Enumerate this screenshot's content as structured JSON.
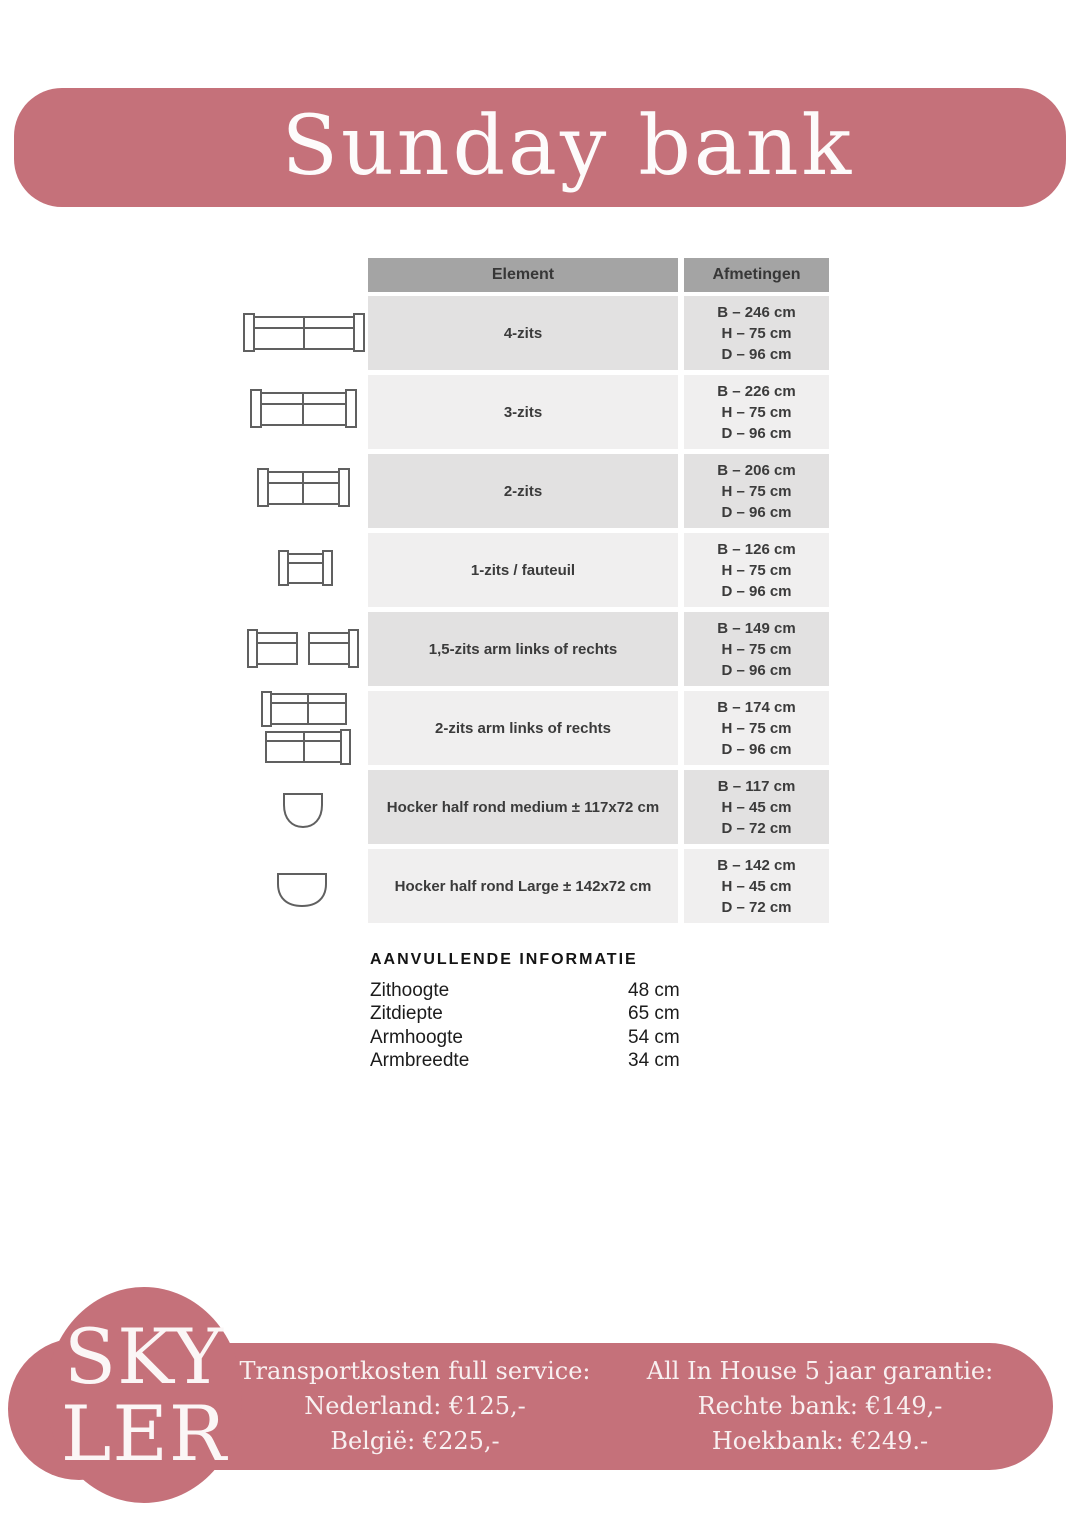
{
  "page": {
    "title": "Sunday bank"
  },
  "table": {
    "headers": {
      "element": "Element",
      "afmetingen": "Afmetingen"
    },
    "rows": [
      {
        "element": "4-zits",
        "dims": [
          "B – 246 cm",
          "H – 75 cm",
          "D – 96 cm"
        ]
      },
      {
        "element": "3-zits",
        "dims": [
          "B – 226 cm",
          "H – 75 cm",
          "D – 96 cm"
        ]
      },
      {
        "element": "2-zits",
        "dims": [
          "B – 206 cm",
          "H – 75 cm",
          "D – 96 cm"
        ]
      },
      {
        "element": "1-zits / fauteuil",
        "dims": [
          "B – 126 cm",
          "H – 75 cm",
          "D – 96 cm"
        ]
      },
      {
        "element": "1,5-zits arm links of rechts",
        "dims": [
          "B – 149 cm",
          "H – 75 cm",
          "D – 96 cm"
        ]
      },
      {
        "element": "2-zits arm links of rechts",
        "dims": [
          "B – 174 cm",
          "H – 75 cm",
          "D – 96 cm"
        ]
      },
      {
        "element": "Hocker half rond medium ± 117x72 cm",
        "dims": [
          "B – 117 cm",
          "H – 45 cm",
          "D – 72 cm"
        ]
      },
      {
        "element": "Hocker half rond Large ± 142x72 cm",
        "dims": [
          "B – 142 cm",
          "H – 45 cm",
          "D – 72 cm"
        ]
      }
    ]
  },
  "additional_info": {
    "heading": "AANVULLENDE INFORMATIE",
    "items": [
      {
        "label": "Zithoogte",
        "value": "48 cm"
      },
      {
        "label": "Zitdiepte",
        "value": "65 cm"
      },
      {
        "label": "Armhoogte",
        "value": "54 cm"
      },
      {
        "label": "Armbreedte",
        "value": "34 cm"
      }
    ]
  },
  "footer": {
    "logo": {
      "line1": "SKY",
      "line2": "LER"
    },
    "transport": {
      "heading": "Transportkosten full service:",
      "lines": [
        "Nederland: €125,-",
        "België: €225,-"
      ]
    },
    "warranty": {
      "heading": "All In House 5 jaar garantie:",
      "lines": [
        "Rechte bank: €149,-",
        "Hoekbank: €249.-"
      ]
    }
  },
  "colors": {
    "accent_pink": "#c5717a",
    "table_header_bg": "#a4a4a4",
    "row_dark": "#e2e1e1",
    "row_light": "#f0efef"
  }
}
